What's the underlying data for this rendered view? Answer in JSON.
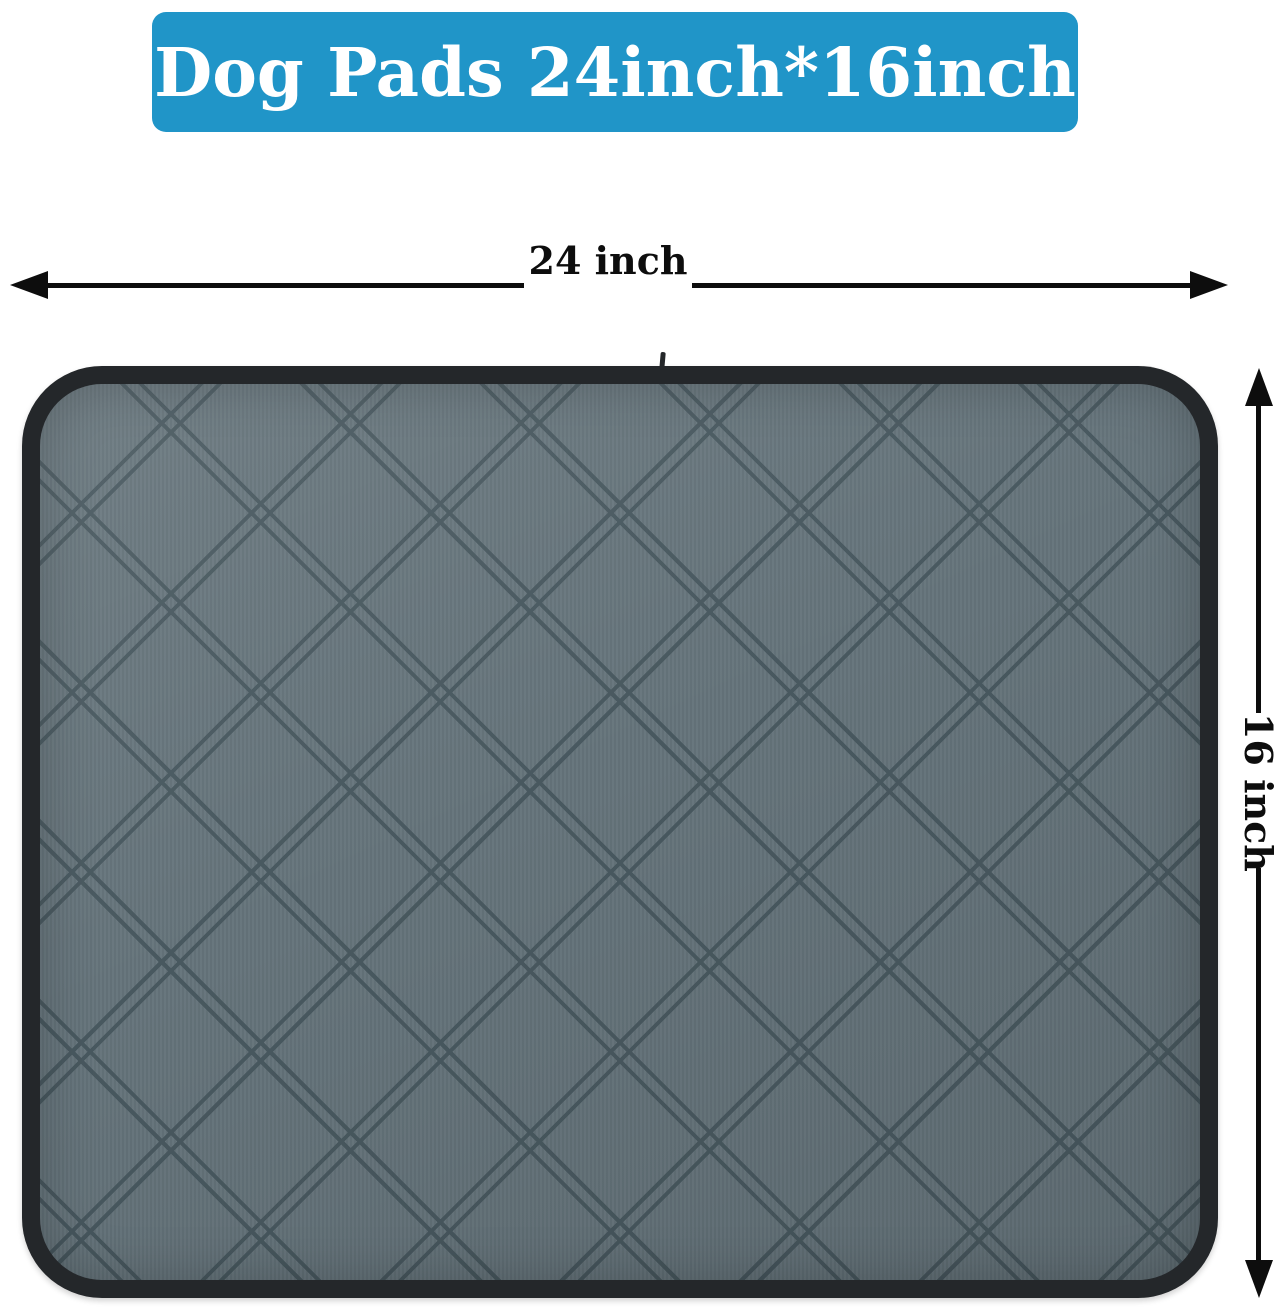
{
  "banner": {
    "title": "Dog Pads 24inch*16inch"
  },
  "dimensions": {
    "width_label": "24 inch",
    "height_label": "16 inch"
  },
  "product": {
    "pattern": "double-diamond quilted fabric with black binding edge"
  },
  "colors": {
    "banner-bg": "#2095c8",
    "banner-text": "#ffffff",
    "fabric": "#65747b",
    "stitch": "#48585f",
    "binding": "#24272a",
    "ink": "#0d0d0d",
    "page-bg": "#ffffff"
  }
}
